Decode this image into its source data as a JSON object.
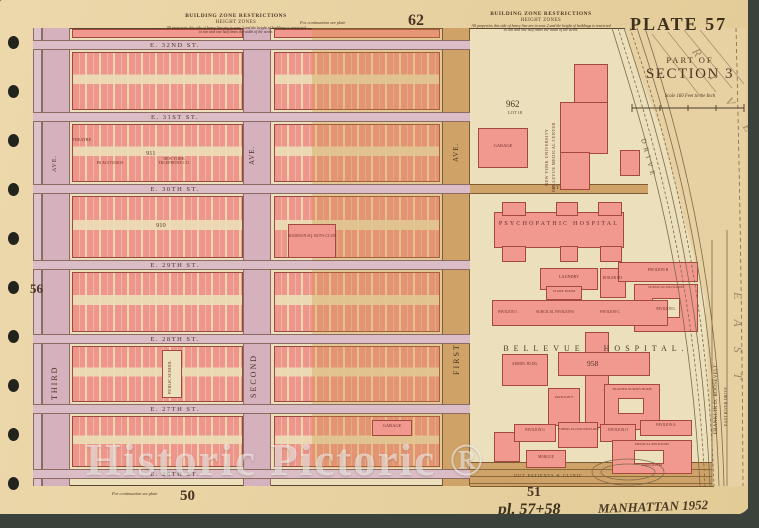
{
  "plate": {
    "number": "PLATE 57",
    "part_of": "PART OF",
    "section": "SECTION 3",
    "scale": "Scale 160 Feet to the Inch"
  },
  "margins": {
    "top": "62",
    "left": "56",
    "bottom_left": "50",
    "bottom_right": "51",
    "note_top": "For continuation see plate",
    "note_bottom": "For continuation see plate"
  },
  "zone_note": {
    "title": "BUILDING ZONE RESTRICTIONS",
    "subtitle": "HEIGHT ZONES",
    "body": "All properties this side of heavy line are in zone 2 and the height of buildings is restricted to two and one half times the width of the street."
  },
  "streets": {
    "e32": "E. 32ND ST.",
    "e31": "E. 31ST ST.",
    "e30": "E. 30TH ST.",
    "e29": "E. 29TH ST.",
    "e28": "E. 28TH ST.",
    "e27": "E. 27TH ST.",
    "e26": "E. 26TH ST.",
    "st_short": "ST."
  },
  "avenues": {
    "third": "THIRD",
    "second": "SECOND",
    "first": "FIRST",
    "ave": "AVE."
  },
  "blocks": {
    "n911": "911",
    "n910": "910",
    "theatre": "THEATRE",
    "film_studios": "FILM STUDIOS",
    "telephone": "NEW YORK TELEPHONE CO.",
    "boys_club": "MADISON SQ. BOYS CLUB",
    "public_school": "PUBLIC SCHOOL",
    "garage": "GARAGE"
  },
  "hospital": {
    "title": "BELLEVUE HOSPITAL.",
    "lot_number": "962",
    "lot_label": "LOT 18",
    "nyu_line1": "NEW YORK UNIVERSITY",
    "nyu_line2": "BELLEVUE MEDICAL CENTER",
    "psychopathic": "PSYCHOPATHIC HOSPITAL",
    "laundry": "LAUNDRY",
    "boiler": "BOILER HO.",
    "store_room": "STORE ROOM",
    "surgical": "SURGICAL PAVILIONS",
    "pavilion_b": "PAVILION B",
    "pavilion_i": "PAVILION I",
    "pavilion_c": "PAVILION C",
    "pavilion_l": "PAVILION L",
    "pavilion_f": "PAVILION F",
    "pavilion_g": "PAVILION G",
    "pavilion_o": "PAVILION O",
    "pavilion_a": "PAVILION A",
    "pavilion_m": "PAVILION M",
    "tuberculosis": "TUBERCULOSIS PAVILION",
    "medical_pavilions": "MEDICAL PAVILIONS",
    "admin": "ADMIN. BLDG.",
    "nurses_home": "TRAINED NURSES HOME",
    "morgue": "MORGUE",
    "out_patients": "OUT PATIENTS & CLINIC",
    "building_958": "958"
  },
  "river": {
    "east": "EAST",
    "river": "RIVER",
    "drive": "DRIVE",
    "fdr_drive": "FRANKLIN D. ROOSEVELT",
    "east_river_drive": "EAST RIVER DRIVE"
  },
  "watermark": "Historic Pictoric ®",
  "handwriting": {
    "plates": "pl. 57+58",
    "caption": "MANHATTAN 1952"
  },
  "colors": {
    "building_pink": "#f2998f",
    "paper_tan": "#e7d1a2",
    "street_rose": "#dabdc7",
    "avenue_tan": "#cfa368",
    "ink_brown": "#4a3423"
  }
}
